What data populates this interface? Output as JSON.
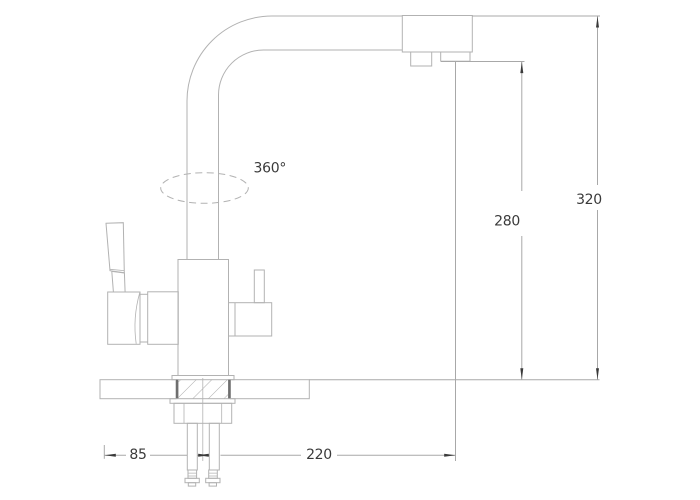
{
  "drawing": {
    "kind": "technical-dimension-drawing",
    "subject": "kitchen-faucet-side-view"
  },
  "dimensions": {
    "rotation": {
      "label": "360°"
    },
    "spout_height": {
      "label": "280"
    },
    "total_height": {
      "label": "320"
    },
    "base_offset": {
      "label": "85"
    },
    "spout_reach": {
      "label": "220"
    }
  },
  "colors": {
    "bg": "#ffffff",
    "line": "#b2b2b2",
    "dim_line": "#a8a8a8",
    "arrow": "#3a3a3a",
    "text": "#3a3a3a",
    "hatch_dark": "#6e6e6e",
    "hatch_cross": "#8f8f8f"
  }
}
